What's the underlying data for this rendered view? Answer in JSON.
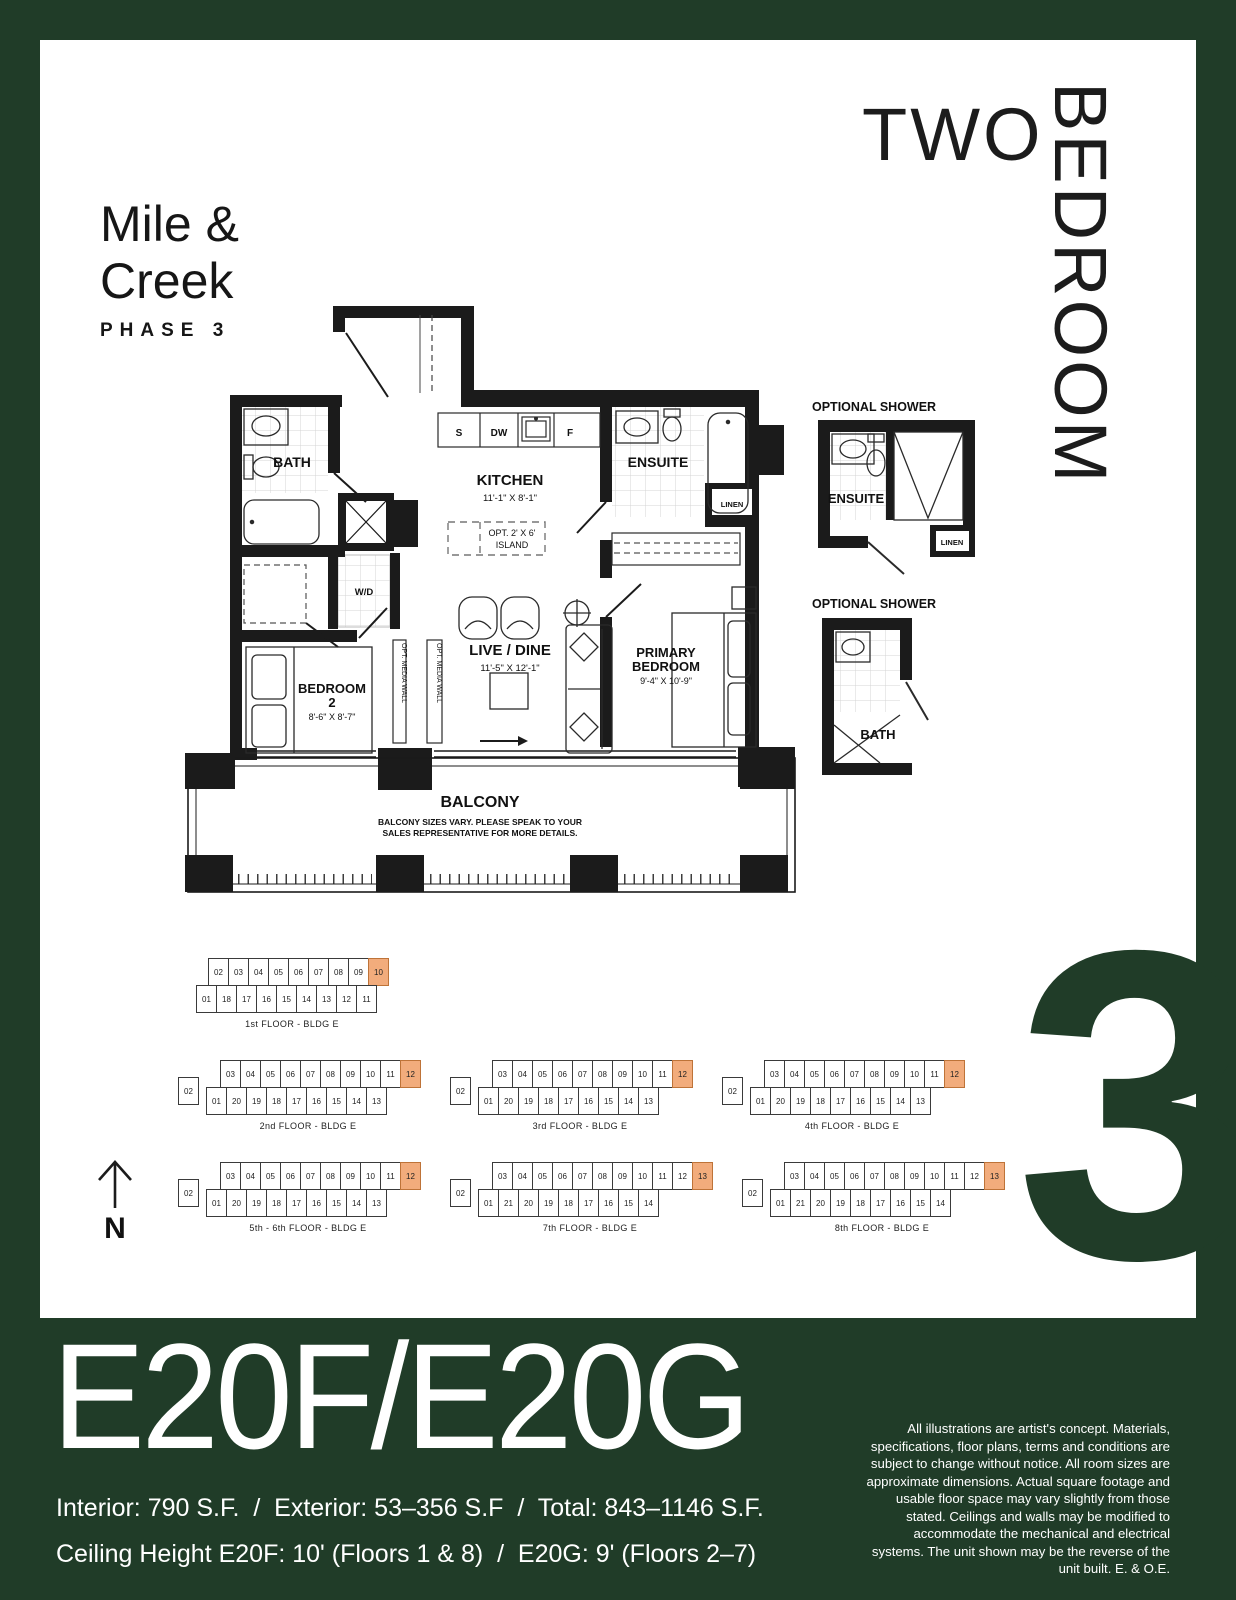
{
  "brand": {
    "line1": "Mile &",
    "line2": "Creek",
    "phase": "PHASE 3"
  },
  "category": {
    "word1": "TWO",
    "word2": "BEDROOM"
  },
  "floorplan": {
    "bath": "BATH",
    "kitchen": "KITCHEN",
    "kitchen_dims": "11'-1\" X 8'-1\"",
    "island_line1": "OPT. 2' X 6'",
    "island_line2": "ISLAND",
    "appliance_s": "S",
    "appliance_dw": "DW",
    "appliance_f": "F",
    "wd": "W/D",
    "ensuite": "ENSUITE",
    "linen": "LINEN",
    "live_dine": "LIVE / DINE",
    "live_dine_dims": "11'-5\" X 12'-1\"",
    "bedroom2_line1": "BEDROOM",
    "bedroom2_line2": "2",
    "bedroom2_dims": "8'-6\" X 8'-7\"",
    "primary_line1": "PRIMARY",
    "primary_line2": "BEDROOM",
    "primary_dims": "9'-4\" X 10'-9\"",
    "media_wall": "OPT. MEDIA WALL",
    "balcony": "BALCONY",
    "balcony_note1": "BALCONY SIZES VARY. PLEASE SPEAK TO YOUR",
    "balcony_note2": "SALES REPRESENTATIVE FOR MORE DETAILS."
  },
  "shower1": {
    "title": "OPTIONAL SHOWER",
    "room": "ENSUITE",
    "linen": "LINEN"
  },
  "shower2": {
    "title": "OPTIONAL SHOWER",
    "room": "BATH"
  },
  "compass": {
    "label": "N"
  },
  "keyplates": [
    {
      "caption": "1st FLOOR - BLDG E",
      "left": [],
      "top": [
        "02",
        "03",
        "04",
        "05",
        "06",
        "07",
        "08",
        "09",
        "10"
      ],
      "bottom": [
        "01",
        "18",
        "17",
        "16",
        "15",
        "14",
        "13",
        "12",
        "11"
      ],
      "highlight": "10"
    },
    {
      "caption": "2nd FLOOR - BLDG E",
      "left": [
        "02"
      ],
      "top": [
        "03",
        "04",
        "05",
        "06",
        "07",
        "08",
        "09",
        "10",
        "11",
        "12"
      ],
      "bottom": [
        "01",
        "20",
        "19",
        "18",
        "17",
        "16",
        "15",
        "14",
        "13"
      ],
      "highlight": "12"
    },
    {
      "caption": "3rd FLOOR - BLDG E",
      "left": [
        "02"
      ],
      "top": [
        "03",
        "04",
        "05",
        "06",
        "07",
        "08",
        "09",
        "10",
        "11",
        "12"
      ],
      "bottom": [
        "01",
        "20",
        "19",
        "18",
        "17",
        "16",
        "15",
        "14",
        "13"
      ],
      "highlight": "12"
    },
    {
      "caption": "4th FLOOR - BLDG E",
      "left": [
        "02"
      ],
      "top": [
        "03",
        "04",
        "05",
        "06",
        "07",
        "08",
        "09",
        "10",
        "11",
        "12"
      ],
      "bottom": [
        "01",
        "20",
        "19",
        "18",
        "17",
        "16",
        "15",
        "14",
        "13"
      ],
      "highlight": "12"
    },
    {
      "caption": "5th - 6th FLOOR - BLDG E",
      "left": [
        "02"
      ],
      "top": [
        "03",
        "04",
        "05",
        "06",
        "07",
        "08",
        "09",
        "10",
        "11",
        "12"
      ],
      "bottom": [
        "01",
        "20",
        "19",
        "18",
        "17",
        "16",
        "15",
        "14",
        "13"
      ],
      "highlight": "12"
    },
    {
      "caption": "7th FLOOR - BLDG E",
      "left": [
        "02"
      ],
      "top": [
        "03",
        "04",
        "05",
        "06",
        "07",
        "08",
        "09",
        "10",
        "11",
        "12",
        "13"
      ],
      "bottom": [
        "01",
        "21",
        "20",
        "19",
        "18",
        "17",
        "16",
        "15",
        "14"
      ],
      "highlight": "13"
    },
    {
      "caption": "8th FLOOR - BLDG E",
      "left": [
        "02"
      ],
      "top": [
        "03",
        "04",
        "05",
        "06",
        "07",
        "08",
        "09",
        "10",
        "11",
        "12",
        "13"
      ],
      "bottom": [
        "01",
        "21",
        "20",
        "19",
        "18",
        "17",
        "16",
        "15",
        "14"
      ],
      "highlight": "13"
    }
  ],
  "phase_numeral": "3",
  "footer": {
    "plan_name": "E20F/E20G",
    "stats": "Interior: 790 S.F.  /  Exterior: 53–356 S.F  /  Total: 843–1146 S.F.",
    "ceiling": "Ceiling Height E20F: 10' (Floors 1 & 8)  /  E20G: 9' (Floors 2–7)",
    "disclaimer": "All illustrations are artist's concept. Materials, specifications, floor plans, terms and conditions are subject to change without notice. All room sizes are approximate dimensions.  Actual square footage and usable floor space may vary slightly from those stated. Ceilings and walls may be modified to accommodate the mechanical and electrical systems.  The unit shown may be the reverse of the unit built.  E. & O.E."
  },
  "colors": {
    "green": "#203C28",
    "highlight": "#F2AC7C"
  }
}
